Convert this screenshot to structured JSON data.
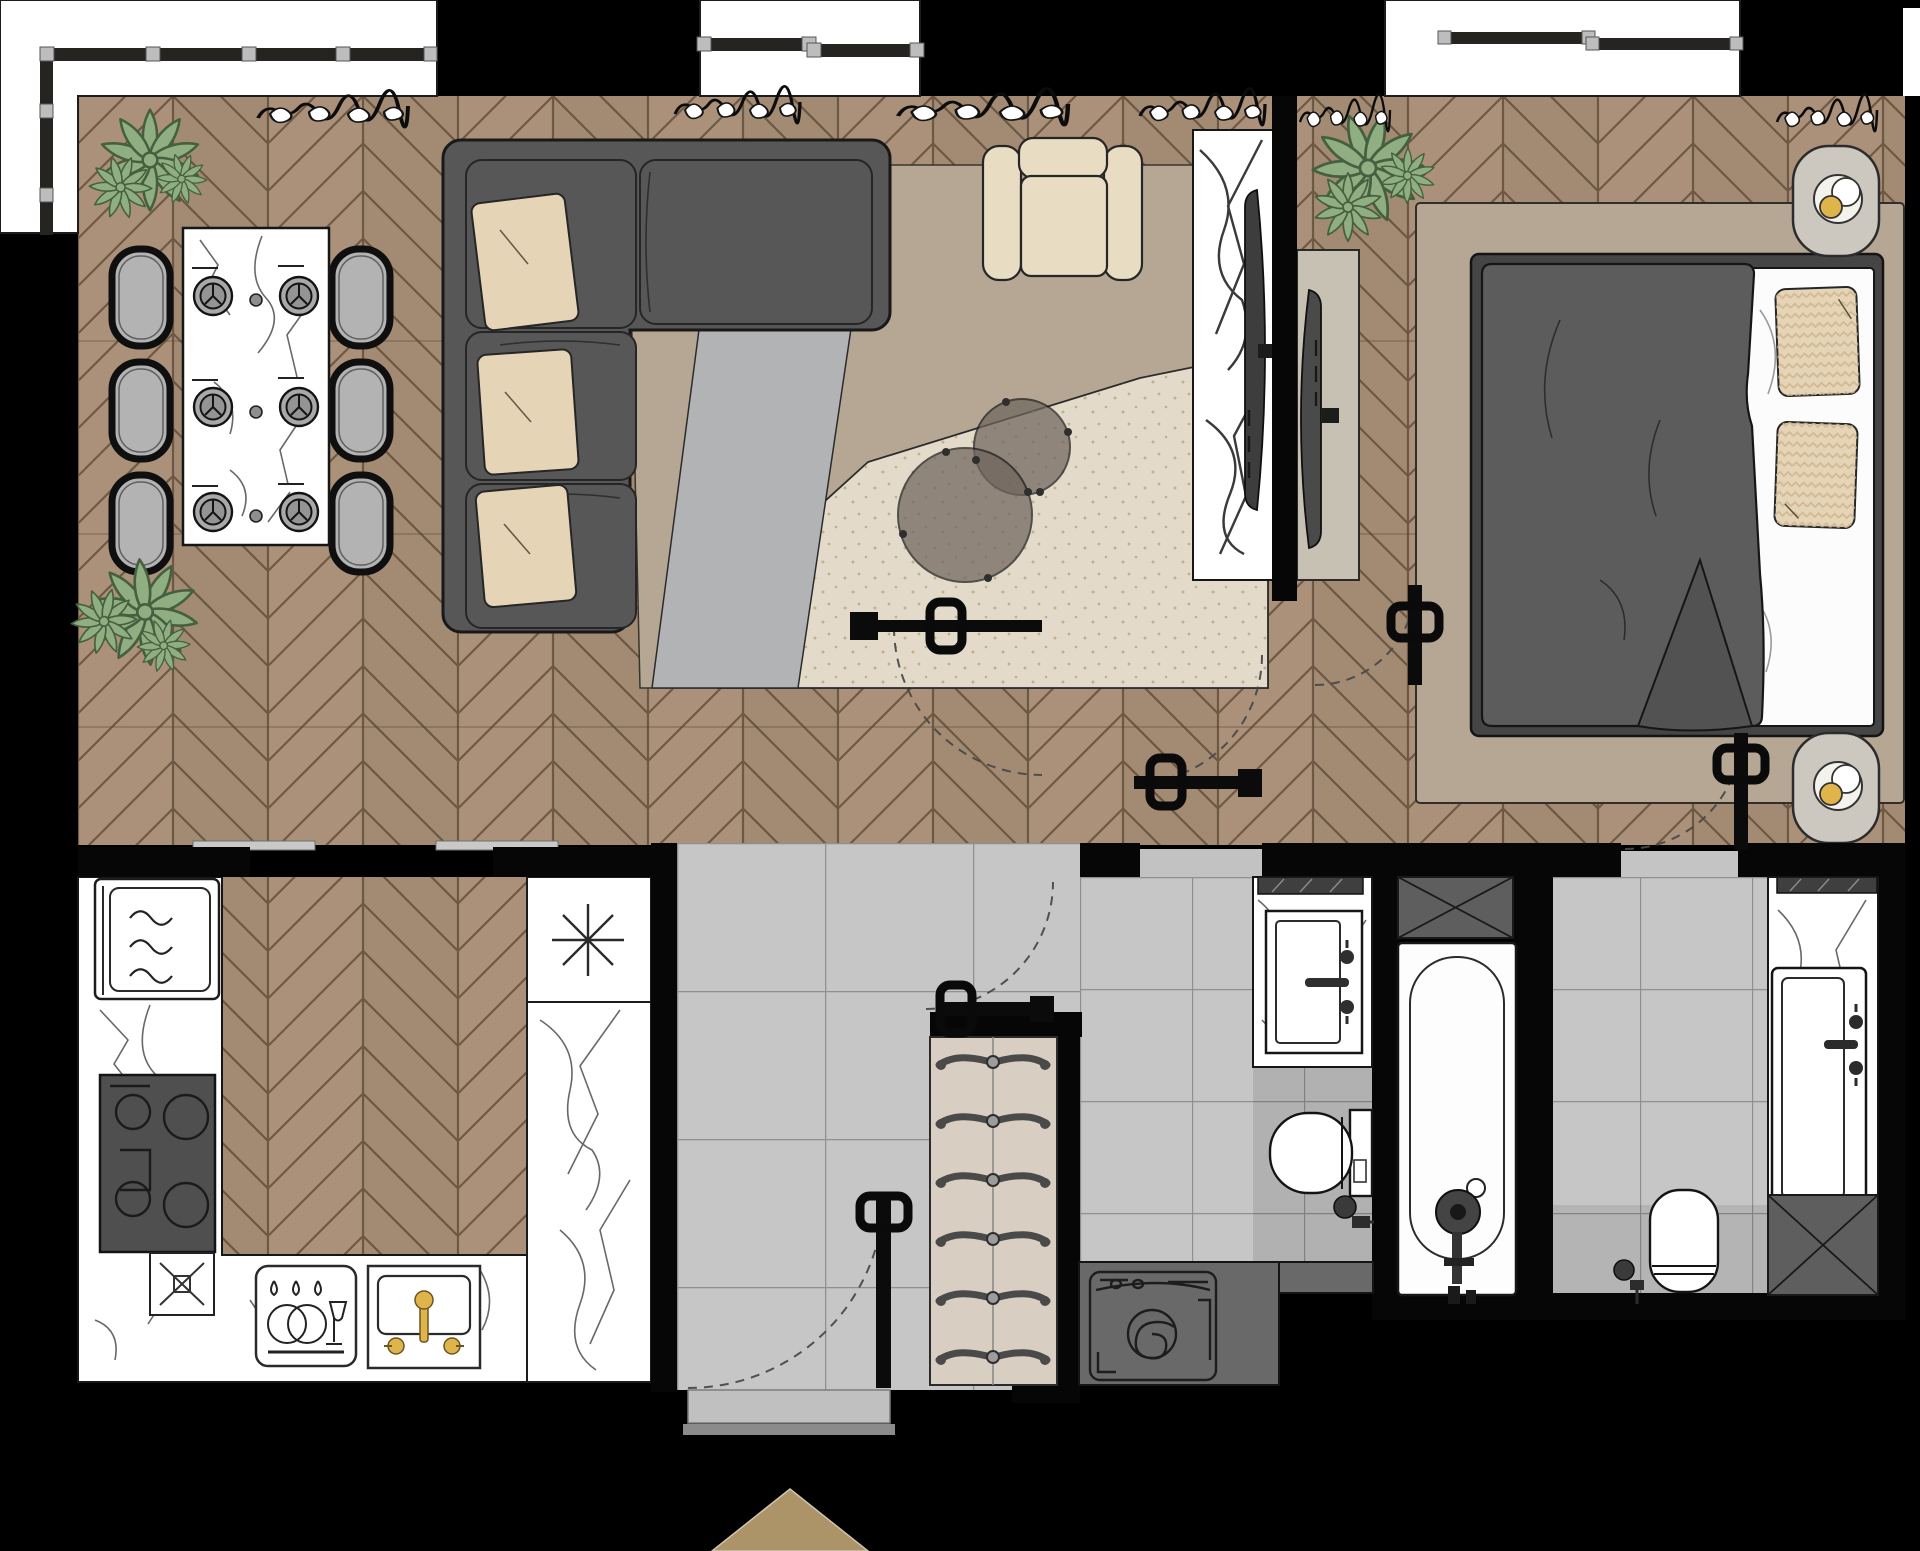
{
  "meta": {
    "title": "Apartment floor plan — top view rendering",
    "type": "architectural-floor-plan",
    "canvas_px": {
      "w": 1920,
      "h": 1551
    }
  },
  "palette": {
    "wood": "#ab9179",
    "woodLine": "#57442f",
    "tile": "#c6c6c6",
    "grout": "#909090",
    "white": "#ffffff",
    "sofa": "#575757",
    "pillow": "#e6d4b6",
    "beige": "#e8dcc3",
    "rugTaupe": "#b5a793",
    "rugGray": "#b1b3b5",
    "rugCream": "#e3dac9",
    "plant": "#8fae82",
    "plantDark": "#44603e",
    "gold": "#dfb54b",
    "duvet": "#5c5c5c",
    "counterDark": "#696969",
    "marbleVein": "#4d4d4d",
    "arrow": "#ac9468",
    "track": "#c9c9c9"
  },
  "rooms": [
    {
      "id": "living-dining",
      "label": "living-dining room",
      "floor": "herringbone wood"
    },
    {
      "id": "bedroom",
      "label": "bedroom",
      "floor": "herringbone wood"
    },
    {
      "id": "kitchen",
      "label": "kitchen",
      "floor": "herringbone wood with stone counters"
    },
    {
      "id": "hallway",
      "label": "entrance hallway",
      "floor": "gray tile"
    },
    {
      "id": "bathroom-main",
      "label": "bathroom with bathtub and washing machine",
      "floor": "gray tile"
    },
    {
      "id": "bathroom-second",
      "label": "second bathroom",
      "floor": "gray tile"
    }
  ],
  "furniture": {
    "living_dining": [
      "marble dining table",
      "6 dining chairs",
      "6 place settings",
      "L-shaped dark sofa",
      "3 beige pillows",
      "beige armchair",
      "2 round coffee tables",
      "layered rugs (taupe, gray, cream)",
      "marble TV wall",
      "wall TV",
      "2 potted plants",
      "curtains"
    ],
    "bedroom": [
      "double bed with dark duvet",
      "2 zigzag pillows",
      "white sheet",
      "area rug",
      "2 nightstands with lamps",
      "TV console",
      "TV",
      "potted plant",
      "curtains"
    ],
    "kitchen": [
      "microwave",
      "cooktop with 4 burners",
      "disposal unit",
      "dishwasher",
      "sink with gold faucet",
      "pendant light symbol",
      "marble counters",
      "double sliding door"
    ],
    "hallway": [
      "shoe rack with 6 shoe pairs",
      "entrance door",
      "entrance step",
      "direction arrow"
    ],
    "bathroom_main": [
      "vanity sink",
      "mirror",
      "toilet with sprayer",
      "washing machine under counter",
      "bathtub with floor faucet",
      "linen cabinet"
    ],
    "bathroom_second": [
      "trough sink",
      "mirror",
      "toilet with sprayer",
      "linen cabinet",
      "marble counter"
    ]
  },
  "openings": {
    "doors": 6,
    "door_style": "black leaf with rounded-square knob and dashed swing arc",
    "windows": [
      "left balcony band",
      "top center window",
      "bedroom window",
      "right sliver"
    ]
  }
}
